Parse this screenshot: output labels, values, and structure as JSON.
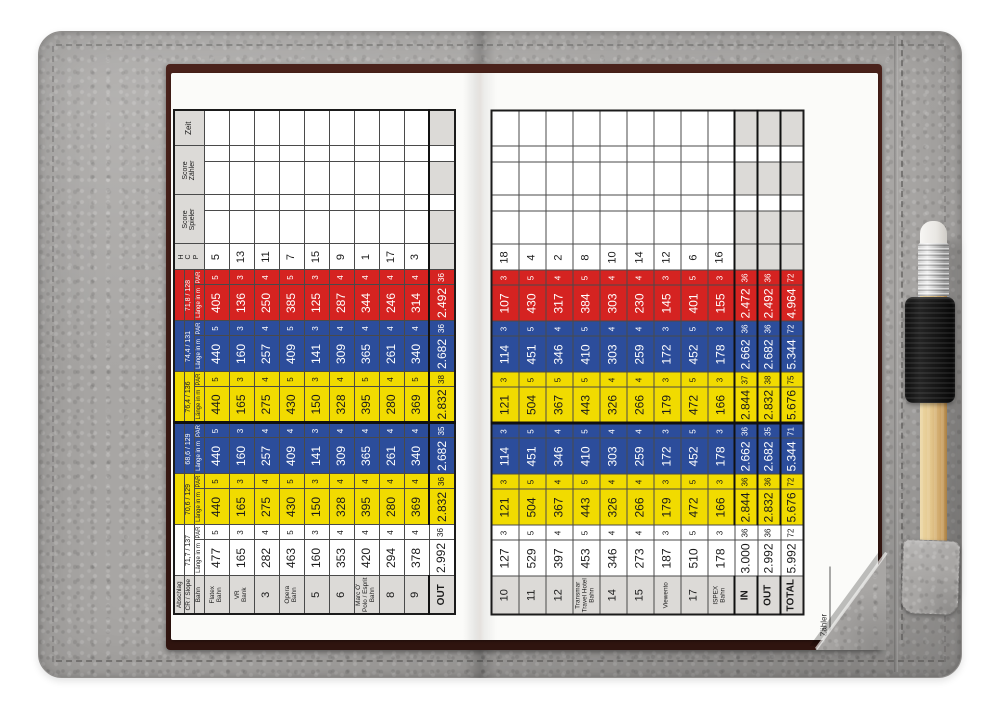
{
  "palette": {
    "leather": "#a8a6a4",
    "card_trim": "#42201a",
    "grid_line": "#4a4a4a",
    "label_cell": "#dcdad7",
    "tee_white": "#ffffff",
    "tee_yellow": "#f1db00",
    "tee_blue": "#2c4d9b",
    "tee_red": "#d52321"
  },
  "card": {
    "labels": {
      "abschlag": "Abschlag",
      "cr_slope": "CR / Slope",
      "bahn": "Bahn",
      "laenge": "Länge in m",
      "par": "PAR",
      "hcp": "H\nC\nP",
      "score_spieler": "Score\nSpieler",
      "score_zaehler": "Score\nZähler",
      "zeit": "Zeit"
    },
    "signature_label": "Zähler",
    "tees": [
      {
        "id": "white",
        "cr_slope": "71,7 / 137",
        "bg": "#ffffff",
        "fg": "#1a1a1a"
      },
      {
        "id": "yellow-men",
        "cr_slope": "70,6 / 129",
        "bg": "#f1db00",
        "fg": "#1a1a1a"
      },
      {
        "id": "blue-men",
        "cr_slope": "68,6 / 129",
        "bg": "#2c4d9b",
        "fg": "#ffffff"
      },
      {
        "id": "yellow-ladies",
        "cr_slope": "76,4 / 136",
        "bg": "#f1db00",
        "fg": "#1a1a1a"
      },
      {
        "id": "blue-ladies",
        "cr_slope": "74,4 / 131",
        "bg": "#2c4d9b",
        "fg": "#ffffff"
      },
      {
        "id": "red-ladies",
        "cr_slope": "71,8 / 128",
        "bg": "#d52321",
        "fg": "#ffffff"
      }
    ],
    "front_nine": {
      "holes": [
        {
          "name": "Flatex\nBahn",
          "hcp": "5",
          "tees": [
            [
              "477",
              "5"
            ],
            [
              "440",
              "5"
            ],
            [
              "440",
              "5"
            ],
            [
              "440",
              "5"
            ],
            [
              "440",
              "5"
            ],
            [
              "405",
              "5"
            ]
          ]
        },
        {
          "name": "VR\nBank",
          "hcp": "13",
          "tees": [
            [
              "165",
              "3"
            ],
            [
              "165",
              "3"
            ],
            [
              "160",
              "3"
            ],
            [
              "165",
              "3"
            ],
            [
              "160",
              "3"
            ],
            [
              "136",
              "3"
            ]
          ]
        },
        {
          "name": "3",
          "hcp": "11",
          "tees": [
            [
              "282",
              "4"
            ],
            [
              "275",
              "4"
            ],
            [
              "257",
              "4"
            ],
            [
              "275",
              "4"
            ],
            [
              "257",
              "4"
            ],
            [
              "250",
              "4"
            ]
          ]
        },
        {
          "name": "Opera\nBahn",
          "hcp": "7",
          "tees": [
            [
              "463",
              "5"
            ],
            [
              "430",
              "5"
            ],
            [
              "409",
              "4"
            ],
            [
              "430",
              "5"
            ],
            [
              "409",
              "5"
            ],
            [
              "385",
              "5"
            ]
          ]
        },
        {
          "name": "5",
          "hcp": "15",
          "tees": [
            [
              "160",
              "3"
            ],
            [
              "150",
              "3"
            ],
            [
              "141",
              "3"
            ],
            [
              "150",
              "3"
            ],
            [
              "141",
              "3"
            ],
            [
              "125",
              "3"
            ]
          ]
        },
        {
          "name": "6",
          "hcp": "9",
          "tees": [
            [
              "353",
              "4"
            ],
            [
              "328",
              "4"
            ],
            [
              "309",
              "4"
            ],
            [
              "328",
              "4"
            ],
            [
              "309",
              "4"
            ],
            [
              "287",
              "4"
            ]
          ]
        },
        {
          "name": "Marc O'\nPolo / Esprit\nBahn",
          "hcp": "1",
          "tees": [
            [
              "420",
              "4"
            ],
            [
              "395",
              "4"
            ],
            [
              "365",
              "4"
            ],
            [
              "395",
              "5"
            ],
            [
              "365",
              "4"
            ],
            [
              "344",
              "4"
            ]
          ]
        },
        {
          "name": "8",
          "hcp": "17",
          "tees": [
            [
              "294",
              "4"
            ],
            [
              "280",
              "4"
            ],
            [
              "261",
              "4"
            ],
            [
              "280",
              "4"
            ],
            [
              "261",
              "4"
            ],
            [
              "246",
              "4"
            ]
          ]
        },
        {
          "name": "9",
          "hcp": "3",
          "tees": [
            [
              "378",
              "4"
            ],
            [
              "369",
              "4"
            ],
            [
              "340",
              "4"
            ],
            [
              "369",
              "5"
            ],
            [
              "340",
              "4"
            ],
            [
              "314",
              "4"
            ]
          ]
        }
      ],
      "totals": [
        {
          "name": "OUT",
          "tees": [
            [
              "2.992",
              "36"
            ],
            [
              "2.832",
              "36"
            ],
            [
              "2.682",
              "35"
            ],
            [
              "2.832",
              "38"
            ],
            [
              "2.682",
              "36"
            ],
            [
              "2.492",
              "36"
            ]
          ]
        }
      ]
    },
    "back_nine": {
      "holes": [
        {
          "name": "10",
          "hcp": "18",
          "tees": [
            [
              "127",
              "3"
            ],
            [
              "121",
              "3"
            ],
            [
              "114",
              "3"
            ],
            [
              "121",
              "3"
            ],
            [
              "114",
              "3"
            ],
            [
              "107",
              "3"
            ]
          ]
        },
        {
          "name": "11",
          "hcp": "4",
          "tees": [
            [
              "529",
              "5"
            ],
            [
              "504",
              "5"
            ],
            [
              "451",
              "5"
            ],
            [
              "504",
              "5"
            ],
            [
              "451",
              "5"
            ],
            [
              "430",
              "5"
            ]
          ]
        },
        {
          "name": "12",
          "hcp": "2",
          "tees": [
            [
              "397",
              "4"
            ],
            [
              "367",
              "4"
            ],
            [
              "346",
              "4"
            ],
            [
              "367",
              "5"
            ],
            [
              "346",
              "4"
            ],
            [
              "317",
              "4"
            ]
          ]
        },
        {
          "name": "Transmar\nTravel Hotel\nBahn",
          "hcp": "8",
          "tees": [
            [
              "453",
              "5"
            ],
            [
              "443",
              "5"
            ],
            [
              "410",
              "5"
            ],
            [
              "443",
              "5"
            ],
            [
              "410",
              "5"
            ],
            [
              "384",
              "5"
            ]
          ]
        },
        {
          "name": "14",
          "hcp": "10",
          "tees": [
            [
              "346",
              "4"
            ],
            [
              "326",
              "4"
            ],
            [
              "303",
              "4"
            ],
            [
              "326",
              "4"
            ],
            [
              "303",
              "4"
            ],
            [
              "303",
              "4"
            ]
          ]
        },
        {
          "name": "15",
          "hcp": "14",
          "tees": [
            [
              "273",
              "4"
            ],
            [
              "266",
              "4"
            ],
            [
              "259",
              "4"
            ],
            [
              "266",
              "4"
            ],
            [
              "259",
              "4"
            ],
            [
              "230",
              "4"
            ]
          ]
        },
        {
          "name": "Viewento",
          "hcp": "12",
          "tees": [
            [
              "187",
              "3"
            ],
            [
              "179",
              "3"
            ],
            [
              "172",
              "3"
            ],
            [
              "179",
              "3"
            ],
            [
              "172",
              "3"
            ],
            [
              "145",
              "3"
            ]
          ]
        },
        {
          "name": "17",
          "hcp": "6",
          "tees": [
            [
              "510",
              "5"
            ],
            [
              "472",
              "5"
            ],
            [
              "452",
              "5"
            ],
            [
              "472",
              "5"
            ],
            [
              "452",
              "5"
            ],
            [
              "401",
              "5"
            ]
          ]
        },
        {
          "name": "ISPEX\nBahn",
          "hcp": "16",
          "tees": [
            [
              "178",
              "3"
            ],
            [
              "166",
              "3"
            ],
            [
              "178",
              "3"
            ],
            [
              "166",
              "3"
            ],
            [
              "178",
              "3"
            ],
            [
              "155",
              "3"
            ]
          ]
        }
      ],
      "totals": [
        {
          "name": "IN",
          "tees": [
            [
              "3.000",
              "36"
            ],
            [
              "2.844",
              "36"
            ],
            [
              "2.662",
              "36"
            ],
            [
              "2.844",
              "37"
            ],
            [
              "2.662",
              "36"
            ],
            [
              "2.472",
              "36"
            ]
          ]
        },
        {
          "name": "OUT",
          "tees": [
            [
              "2.992",
              "36"
            ],
            [
              "2.832",
              "36"
            ],
            [
              "2.682",
              "35"
            ],
            [
              "2.832",
              "38"
            ],
            [
              "2.682",
              "36"
            ],
            [
              "2.492",
              "36"
            ]
          ]
        },
        {
          "name": "TOTAL",
          "tees": [
            [
              "5.992",
              "72"
            ],
            [
              "5.676",
              "72"
            ],
            [
              "5.344",
              "71"
            ],
            [
              "5.676",
              "75"
            ],
            [
              "5.344",
              "72"
            ],
            [
              "4.964",
              "72"
            ]
          ]
        }
      ]
    }
  }
}
